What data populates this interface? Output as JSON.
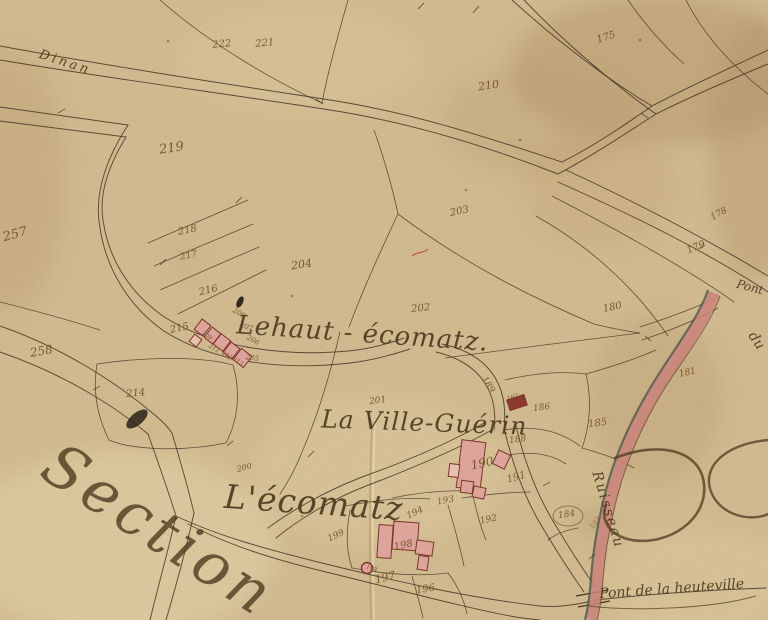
{
  "map": {
    "description": "Hand-drawn 19th-century French cadastral map sheet, aged paper, parcels with brown ink numbers, pink buildings, pink river band",
    "colors": {
      "paper": "#d4bd92",
      "paper_light": "#e7d6ac",
      "paper_dark": "#ab8b5d",
      "line_ink": "#463524",
      "number_ink": "#6f4e24",
      "label_ink": "#4d3a1f",
      "building_fill": "#dca49a",
      "building_light": "#e7c0b2",
      "building_dark": "#8c3a30",
      "building_stroke": "#7e352b",
      "river_band": "#c9837b",
      "river_edge": "#4e5a4a",
      "stain": "#8d6b42",
      "red_mark": "#b4453a"
    },
    "place_labels": [
      {
        "id": "road-to-dinan",
        "text": "Dinan",
        "x": 64,
        "y": 66,
        "r": 18,
        "s": 13,
        "sp": 3
      },
      {
        "id": "hamlet-lehaut-ecomatz",
        "text": "Lehaut - écomatz.",
        "x": 362,
        "y": 342,
        "r": 4,
        "s": 26,
        "sp": 1
      },
      {
        "id": "hamlet-la-ville-guerin",
        "text": "La Ville-Guérin",
        "x": 424,
        "y": 431,
        "r": 2,
        "s": 25,
        "sp": 1
      },
      {
        "id": "hamlet-lecomatz",
        "text": "L'écomatz",
        "x": 313,
        "y": 514,
        "r": 4,
        "s": 33,
        "sp": 1
      },
      {
        "id": "section-title",
        "text": "Section",
        "x": 148,
        "y": 547,
        "r": 33,
        "s": 60,
        "sp": 5,
        "o": 0.8
      },
      {
        "id": "pont-upper",
        "text": "Pont",
        "x": 749,
        "y": 291,
        "r": 15,
        "s": 12,
        "sp": 0
      },
      {
        "id": "river-du",
        "text": "du",
        "x": 753,
        "y": 343,
        "r": 55,
        "s": 14,
        "sp": 0
      },
      {
        "id": "river-ruisseau",
        "text": "Ruisseau",
        "x": 604,
        "y": 511,
        "r": 73,
        "s": 14,
        "sp": 2
      },
      {
        "id": "pont-de-la-heuteville",
        "text": "Pont de la heuteville",
        "x": 672,
        "y": 593,
        "r": -4,
        "s": 14,
        "sp": 0
      }
    ],
    "parcel_numbers": [
      {
        "n": "222",
        "x": 222,
        "y": 47,
        "r": -5,
        "s": 10
      },
      {
        "n": "221",
        "x": 265,
        "y": 46,
        "r": -5,
        "s": 10
      },
      {
        "n": "175",
        "x": 607,
        "y": 40,
        "r": -18,
        "s": 10
      },
      {
        "n": "210",
        "x": 489,
        "y": 89,
        "r": -8,
        "s": 11
      },
      {
        "n": "219",
        "x": 172,
        "y": 152,
        "r": -8,
        "s": 13
      },
      {
        "n": "257",
        "x": 16,
        "y": 238,
        "r": -15,
        "s": 13
      },
      {
        "n": "218",
        "x": 188,
        "y": 233,
        "r": -12,
        "s": 10
      },
      {
        "n": "217",
        "x": 189,
        "y": 258,
        "r": -12,
        "s": 9
      },
      {
        "n": "204",
        "x": 302,
        "y": 268,
        "r": -8,
        "s": 11
      },
      {
        "n": "203",
        "x": 460,
        "y": 214,
        "r": -12,
        "s": 10
      },
      {
        "n": "216",
        "x": 209,
        "y": 293,
        "r": -14,
        "s": 10
      },
      {
        "n": "202",
        "x": 421,
        "y": 311,
        "r": -6,
        "s": 10
      },
      {
        "n": "208",
        "x": 238,
        "y": 315,
        "r": 30,
        "s": 7
      },
      {
        "n": "207",
        "x": 246,
        "y": 329,
        "r": 15,
        "s": 7
      },
      {
        "n": "206",
        "x": 252,
        "y": 342,
        "r": 30,
        "s": 7
      },
      {
        "n": "205",
        "x": 252,
        "y": 360,
        "r": 8,
        "s": 7
      },
      {
        "n": "215",
        "x": 180,
        "y": 331,
        "r": -12,
        "s": 10
      },
      {
        "n": "209",
        "x": 206,
        "y": 337,
        "r": 35,
        "s": 6
      },
      {
        "n": "211",
        "x": 213,
        "y": 350,
        "r": 35,
        "s": 6
      },
      {
        "n": "212",
        "x": 226,
        "y": 357,
        "r": 35,
        "s": 6
      },
      {
        "n": "213",
        "x": 237,
        "y": 363,
        "r": 35,
        "s": 6
      },
      {
        "n": "258",
        "x": 42,
        "y": 355,
        "r": -10,
        "s": 12
      },
      {
        "n": "214",
        "x": 136,
        "y": 396,
        "r": -5,
        "s": 10
      },
      {
        "n": "178",
        "x": 720,
        "y": 216,
        "r": -28,
        "s": 9
      },
      {
        "n": "179",
        "x": 697,
        "y": 250,
        "r": -22,
        "s": 10
      },
      {
        "n": "180",
        "x": 613,
        "y": 310,
        "r": -12,
        "s": 10
      },
      {
        "n": "181",
        "x": 688,
        "y": 375,
        "r": -12,
        "s": 9
      },
      {
        "n": "185",
        "x": 598,
        "y": 426,
        "r": -8,
        "s": 10
      },
      {
        "n": "189",
        "x": 486,
        "y": 386,
        "r": 58,
        "s": 9
      },
      {
        "n": "187",
        "x": 513,
        "y": 399,
        "r": -15,
        "s": 6
      },
      {
        "n": "186",
        "x": 542,
        "y": 410,
        "r": -8,
        "s": 9
      },
      {
        "n": "201",
        "x": 378,
        "y": 403,
        "r": -8,
        "s": 9
      },
      {
        "n": "188",
        "x": 518,
        "y": 442,
        "r": -8,
        "s": 9
      },
      {
        "n": "190",
        "x": 483,
        "y": 467,
        "r": -12,
        "s": 12
      },
      {
        "n": "191",
        "x": 517,
        "y": 480,
        "r": -15,
        "s": 10
      },
      {
        "n": "193",
        "x": 446,
        "y": 503,
        "r": -10,
        "s": 9
      },
      {
        "n": "192",
        "x": 489,
        "y": 522,
        "r": -12,
        "s": 9
      },
      {
        "n": "184",
        "x": 567,
        "y": 517,
        "r": -8,
        "s": 9
      },
      {
        "n": "183",
        "x": 597,
        "y": 524,
        "r": -55,
        "s": 7,
        "o": 0.55
      },
      {
        "n": "200",
        "x": 245,
        "y": 470,
        "r": -15,
        "s": 8
      },
      {
        "n": "199",
        "x": 337,
        "y": 538,
        "r": -25,
        "s": 9
      },
      {
        "n": "194",
        "x": 416,
        "y": 515,
        "r": -25,
        "s": 9
      },
      {
        "n": "198",
        "x": 404,
        "y": 548,
        "r": -12,
        "s": 10
      },
      {
        "n": "198",
        "x": 371,
        "y": 570,
        "r": 20,
        "s": 6
      },
      {
        "n": "197",
        "x": 386,
        "y": 581,
        "r": -15,
        "s": 11
      },
      {
        "n": "196",
        "x": 426,
        "y": 592,
        "r": -10,
        "s": 10
      }
    ],
    "buildings": [
      {
        "x": 197,
        "y": 321,
        "w": 11,
        "h": 13,
        "r": 38
      },
      {
        "x": 207,
        "y": 329,
        "w": 11,
        "h": 13,
        "r": 38
      },
      {
        "x": 216,
        "y": 336,
        "w": 12,
        "h": 13,
        "r": 38
      },
      {
        "x": 226,
        "y": 344,
        "w": 11,
        "h": 13,
        "r": 38
      },
      {
        "x": 236,
        "y": 351,
        "w": 13,
        "h": 14,
        "r": 38
      },
      {
        "x": 191,
        "y": 336,
        "w": 9,
        "h": 9,
        "r": 38,
        "light": true
      },
      {
        "x": 459,
        "y": 441,
        "w": 24,
        "h": 48,
        "r": 7
      },
      {
        "x": 495,
        "y": 452,
        "w": 13,
        "h": 15,
        "r": 25
      },
      {
        "x": 449,
        "y": 464,
        "w": 10,
        "h": 13,
        "r": 7,
        "light": true
      },
      {
        "x": 461,
        "y": 481,
        "w": 12,
        "h": 12,
        "r": 7
      },
      {
        "x": 473,
        "y": 487,
        "w": 12,
        "h": 11,
        "r": 12
      },
      {
        "x": 508,
        "y": 397,
        "w": 18,
        "h": 11,
        "r": -18,
        "dark": true
      },
      {
        "x": 378,
        "y": 525,
        "w": 14,
        "h": 33,
        "r": 4
      },
      {
        "x": 393,
        "y": 522,
        "w": 25,
        "h": 28,
        "r": 4
      },
      {
        "x": 416,
        "y": 541,
        "w": 17,
        "h": 14,
        "r": 8
      },
      {
        "x": 418,
        "y": 556,
        "w": 10,
        "h": 14,
        "r": 8
      }
    ],
    "well": {
      "cx": 367,
      "cy": 568,
      "r": 5.5
    },
    "number_oval_184": {
      "cx": 568,
      "cy": 516,
      "rx": 15,
      "ry": 10
    }
  }
}
